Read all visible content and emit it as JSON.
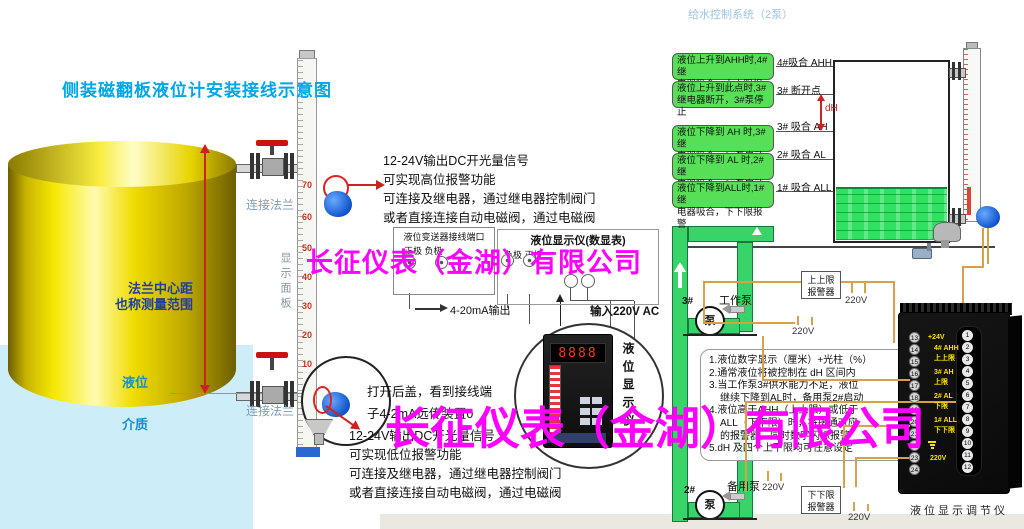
{
  "title": "侧装磁翻板液位计安装接线示意图",
  "top_right_title": "给水控制系统（2泵）",
  "watermark": {
    "text": "长征仪表（金湖）有限公司",
    "color": "#ff00ff"
  },
  "left_diagram": {
    "dim_line1": "法兰中心距",
    "dim_line2": "也称测量范围",
    "level_label": "液位",
    "medium_label": "介质",
    "flange_top": "连接法兰",
    "flange_bottom": "连接法兰",
    "panel_label": "显示面板",
    "scale": [
      "70",
      "60",
      "50",
      "40",
      "30",
      "20",
      "10"
    ]
  },
  "high_note": {
    "l1": "12-24V输出DC开光量信号",
    "l2": "可实现高位报警功能",
    "l3": "可连接及继电器，通过继电器控制阀门",
    "l4": "或者直接连接自动电磁阀，通过电磁阀"
  },
  "open_note": {
    "l1": "打开后盖，看到接线端",
    "l2": "子4-2mA远传装置0"
  },
  "low_note": {
    "l1": "12-24V输出DC开光量信号",
    "l2": "可实现低位报警功能",
    "l3": "可连接及继电器，通过继电器控制阀门",
    "l4": "或者直接连接自动电磁阀，通过电磁阀"
  },
  "mid_wiring": {
    "transmitter_box_title": "液位变送器接线端口",
    "transmitter_polarity": "正极 负极",
    "display_box_title": "液位显示仪(数显表)",
    "display_polarity": "负极 正极",
    "output_label": "4-20mA输出",
    "input_label": "输入220V AC",
    "display_unit_vertical": "液位显示仪",
    "display_digits": "8888"
  },
  "right_diagram": {
    "green_notes": [
      {
        "line1": "液位上升到AHH时,4#继",
        "line2": "电器吸合，上上限报警",
        "label": "4#吸合 AHH"
      },
      {
        "line1": "液位上升到此点时,3#",
        "line2": "继电器断开，3#泵停止",
        "label": "3# 断开点"
      },
      {
        "line1": "液位下降到 AH 时,3#继",
        "line2": "电器吸合，3#泵启动",
        "label": "3# 吸合 AH"
      },
      {
        "line1": "液位下降到 AL 时,2#继",
        "line2": "电器吸合，2#泵启动",
        "label": "2# 吸合 AL"
      },
      {
        "line1": "液位下降到ALL时,1#继",
        "line2": "电器吸合，下下限报警",
        "label": "1# 吸合 ALL"
      }
    ],
    "dh_label": "dH",
    "upper_alarm_l1": "上上限",
    "upper_alarm_l2": "报警器",
    "lower_alarm_l1": "下下限",
    "lower_alarm_l2": "报警器",
    "working_pump_id": "3#",
    "working_pump_label": "工作泵",
    "backup_pump_id": "2#",
    "backup_pump_label": "备用泵",
    "pump_symbol": "泵",
    "v220": "220V",
    "notes_lines": [
      "1.液位数字显示（厘米）+光柱（%）",
      "2.通常液位将被控制在 dH 区间内",
      "3.当工作泵3#供水能力不足，液位",
      "继续下降到AL时，备用泵2#启动",
      "4.液位高于AHH（上上限）或低于",
      "ALL（下下限）时，将接通对应",
      "的报警器，同时数字闪烁报警",
      "5.dH 及四个上下限均可任意设定"
    ],
    "controller_label": "液位显示调节仪",
    "instrument": {
      "left_terminals": [
        "13",
        "14",
        "15",
        "16",
        "17",
        "18",
        "19",
        "20",
        "21",
        "22",
        "23",
        "24"
      ],
      "right_terminals": [
        "1",
        "2",
        "3",
        "4",
        "5",
        "6",
        "7",
        "8",
        "9",
        "10",
        "11",
        "12"
      ],
      "t13_label": "+24V",
      "g1_l1": "4# AHH",
      "g1_l2": "上上限",
      "g2_l1": "3# AH",
      "g2_l2": "上限",
      "g3_l1": "2# AL",
      "g3_l2": "下限",
      "g4_l1": "1# ALL",
      "g4_l2": "下下限",
      "power_label": "220V"
    }
  }
}
